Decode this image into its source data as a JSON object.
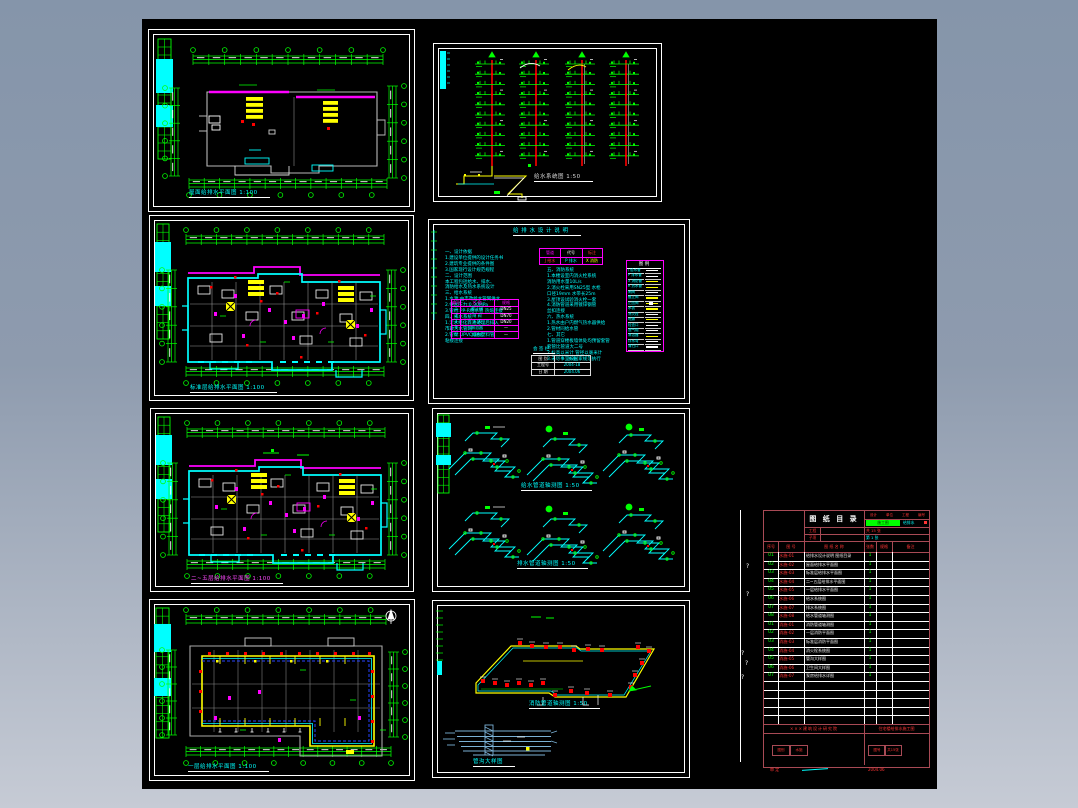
{
  "window": {
    "background_top": "#8595aa",
    "background_bottom": "#c6cbd5",
    "canvas_color": "#000000"
  },
  "colors": {
    "line_green": "#00ff00",
    "line_cyan": "#00ffff",
    "line_magenta": "#ff00ff",
    "line_yellow": "#ffff00",
    "line_red": "#ff0000",
    "wall_gray": "#b9b9b9",
    "table_border_red": "#a84a55",
    "detail_blue": "#7ab0d4",
    "dashed_blue": "#2743ff"
  },
  "panels": {
    "p1": {
      "title": "屋面给排水平面图 1:100"
    },
    "p2": {
      "title": "给水系统图 1:50"
    },
    "p3": {
      "title": "标准层给排水平面图 1:100"
    },
    "p4": {
      "title": "给 排 水 设 计 说 明"
    },
    "p5": {
      "title": "二~五层给排水平面图 1:100"
    },
    "p6": {
      "title": "给水管道轴测图 1:50",
      "title2": "排水管道轴测图 1:50"
    },
    "p7": {
      "title": "一层给排水平面图 1:100"
    },
    "p8": {
      "title": "消防管道轴测图 1:50",
      "title2": "管沟大样图"
    }
  },
  "notes": {
    "left_lines": [
      "一、设计依据",
      "1.建设单位提供的设计任务书",
      "2.建筑专业提供的条件图",
      "3.国家现行设计规范规程",
      "二、设计范围",
      "本工程包括给水、排水、",
      "消防给水及热水系统设计",
      "三、给水系统",
      "1.水源:由市政给水管网供水",
      "2.供水压力:0.30MPa",
      "3.管材:PP-R给水管 热熔连接",
      "四、排水系统",
      "1.污水经化粪池处理后排入",
      "  市政污水管网",
      "2.管材:UPVC排水塑料管",
      "  粘接连接"
    ],
    "center_lines": [
      "五、消防系统",
      "1.本楼设室内消火栓系统",
      "  消防用水量10L/s",
      "2.消火栓采用SN25型 水枪",
      "  口径19mm 水带长25m",
      "3.屋顶设试验消火栓一套",
      "4.消防管道采用镀锌钢管",
      "  丝扣连接",
      "六、热水系统",
      "1.热水由户内燃气热水器供给",
      "2.管材同给水管",
      "七、其它",
      "1.管道穿楼板墙体处均预留套管",
      "  套管比管道大二号",
      "2.标高以米计 管径以毫米计",
      "3.未尽事宜按国家规范执行"
    ],
    "material_table": {
      "headers": [
        "编号",
        "名  称",
        "规格"
      ],
      "rows": [
        [
          "1",
          "截止阀",
          "DN25"
        ],
        [
          "2",
          "闸  阀",
          "DN70"
        ],
        [
          "3",
          "水  表",
          "DN20"
        ],
        [
          "4",
          "淋浴器",
          "—"
        ],
        [
          "5",
          "大便器",
          "—"
        ]
      ]
    },
    "top_table": {
      "rows": [
        [
          "管道",
          "代号",
          "标注"
        ],
        [
          "J 给水",
          "P 排水",
          "X 消防"
        ]
      ]
    },
    "legend": {
      "title": "图 例",
      "rows": [
        {
          "label": "J 给水管",
          "line": "white"
        },
        {
          "label": "P 排水管",
          "line": "white"
        },
        {
          "label": "X 消防管",
          "line": "yellow"
        },
        {
          "label": "R 热水管",
          "line": "yellow"
        },
        {
          "label": "闸阀",
          "line": "white"
        },
        {
          "label": "截止阀",
          "line": "yellow"
        },
        {
          "label": "止回阀",
          "line": "mixed"
        },
        {
          "label": "水表",
          "line": "yellow"
        },
        {
          "label": "消火栓",
          "line": "white"
        },
        {
          "label": "地漏",
          "line": "yellow"
        },
        {
          "label": "检查口",
          "line": "white"
        },
        {
          "label": "透气帽",
          "line": "white"
        },
        {
          "label": "淋浴器",
          "line": "yellow"
        },
        {
          "label": "存水弯",
          "line": "white"
        },
        {
          "label": "清扫口",
          "line": "white"
        }
      ]
    },
    "record_title": "会 签 栏",
    "record_table": [
      [
        "图 别",
        "水 施"
      ],
      [
        "工程号",
        "2004-18"
      ],
      [
        "日 期",
        "2004.06"
      ]
    ]
  },
  "drawing_list": {
    "title": "图 纸 目 录",
    "r1_cells": [
      "设计",
      "单位",
      "工程",
      "编号"
    ],
    "stage": "施工图",
    "discipline": "给排水",
    "project_rows": [
      {
        "label": "工程"
      },
      {
        "label": "子项"
      }
    ],
    "sheets_total": "共 15 张",
    "sheet_no": "第 1 张",
    "columns": [
      "序号",
      "图 号",
      "图 纸 名 称",
      "张数",
      "规格",
      "备注"
    ],
    "rows": [
      {
        "no": "01",
        "code": "水施-01",
        "name": "给排水设计说明 图纸目录",
        "qty": "1"
      },
      {
        "no": "02",
        "code": "水施-02",
        "name": "屋面给排水平面图",
        "qty": "1"
      },
      {
        "no": "03",
        "code": "水施-03",
        "name": "标准层给排水平面图",
        "qty": "1"
      },
      {
        "no": "04",
        "code": "水施-04",
        "name": "二~五层给排水平面图",
        "qty": "1"
      },
      {
        "no": "05",
        "code": "水施-05",
        "name": "一层给排水平面图",
        "qty": "1"
      },
      {
        "no": "06",
        "code": "水施-06",
        "name": "给水系统图",
        "qty": "1"
      },
      {
        "no": "07",
        "code": "水施-07",
        "name": "排水系统图",
        "qty": "1"
      },
      {
        "no": "08",
        "code": "水施-08",
        "name": "给水管道轴测图",
        "qty": "1"
      },
      {
        "no": "01",
        "code": "消施-01",
        "name": "消防管道轴测图",
        "qty": "1"
      },
      {
        "no": "02",
        "code": "消施-02",
        "name": "一层消防平面图",
        "qty": "1"
      },
      {
        "no": "03",
        "code": "消施-03",
        "name": "标准层消防平面图",
        "qty": "1"
      },
      {
        "no": "04",
        "code": "消施-04",
        "name": "消火栓系统图",
        "qty": "1"
      },
      {
        "no": "05",
        "code": "消施-05",
        "name": "管沟大样图",
        "qty": "1"
      },
      {
        "no": "06",
        "code": "消施-06",
        "name": "卫生间大样图",
        "qty": "1"
      },
      {
        "no": "07",
        "code": "消施-07",
        "name": "泵房给排水详图",
        "qty": "1"
      }
    ],
    "footer": {
      "left": "×××建筑设计研究院",
      "right": "住宅楼给排水施工图",
      "box1": "图别",
      "box2": "水施",
      "box3": "图号",
      "box4": "共15张"
    },
    "fold_marks": [
      "?",
      "?",
      "?",
      "?",
      "?"
    ],
    "below": {
      "left": "审 定",
      "right": "2004.06"
    }
  }
}
